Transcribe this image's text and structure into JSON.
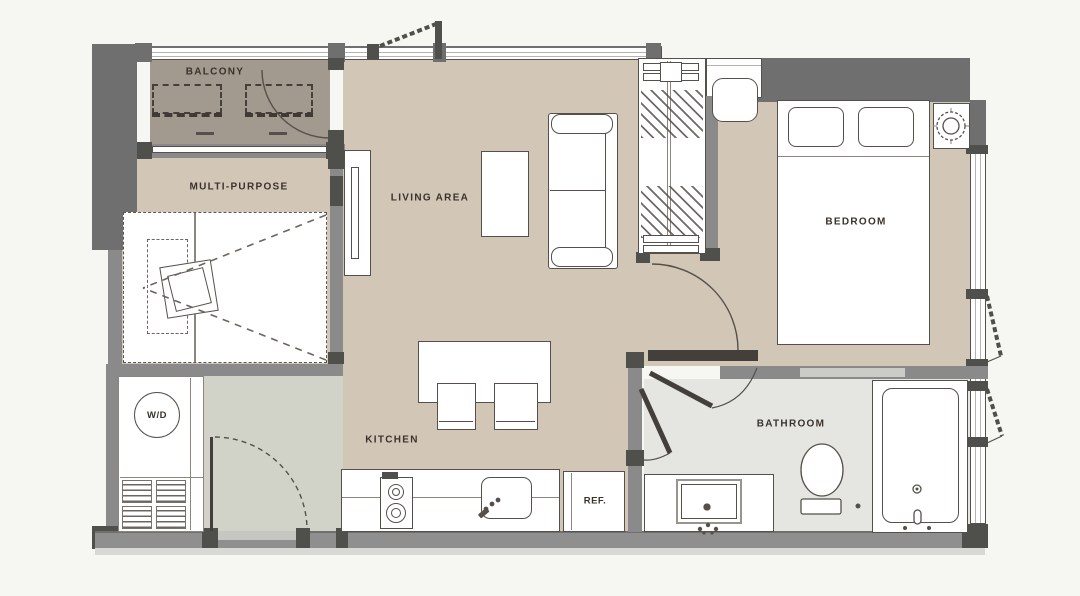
{
  "rooms": {
    "balcony": {
      "label": "BALCONY"
    },
    "multi_purpose": {
      "label": "MULTI-PURPOSE"
    },
    "living_area": {
      "label": "LIVING AREA"
    },
    "bedroom": {
      "label": "BEDROOM"
    },
    "kitchen": {
      "label": "KITCHEN"
    },
    "bathroom": {
      "label": "BATHROOM"
    }
  },
  "fixtures": {
    "washer_dryer": {
      "label": "W/D"
    },
    "refrigerator": {
      "label": "REF."
    }
  },
  "colors": {
    "background": "#f6f6f3",
    "floor_main": "#d2c7b7",
    "floor_balcony": "#a29a8f",
    "floor_hall": "#d1d2c8",
    "floor_bath": "#e5e5e1",
    "wall_outer": "#6f6f6f",
    "wall_inner": "#8a8a8a",
    "wall_bottom": "#8f8f8f",
    "wall_dark": "#4f4f4b",
    "threshold": "#c6c6c2",
    "apron": "#d8d8d4",
    "line": "#55504b",
    "line_light": "#8a857e",
    "door_leaf": "#433f3a",
    "label_text": "#3a332c",
    "furniture": "#ffffff"
  }
}
